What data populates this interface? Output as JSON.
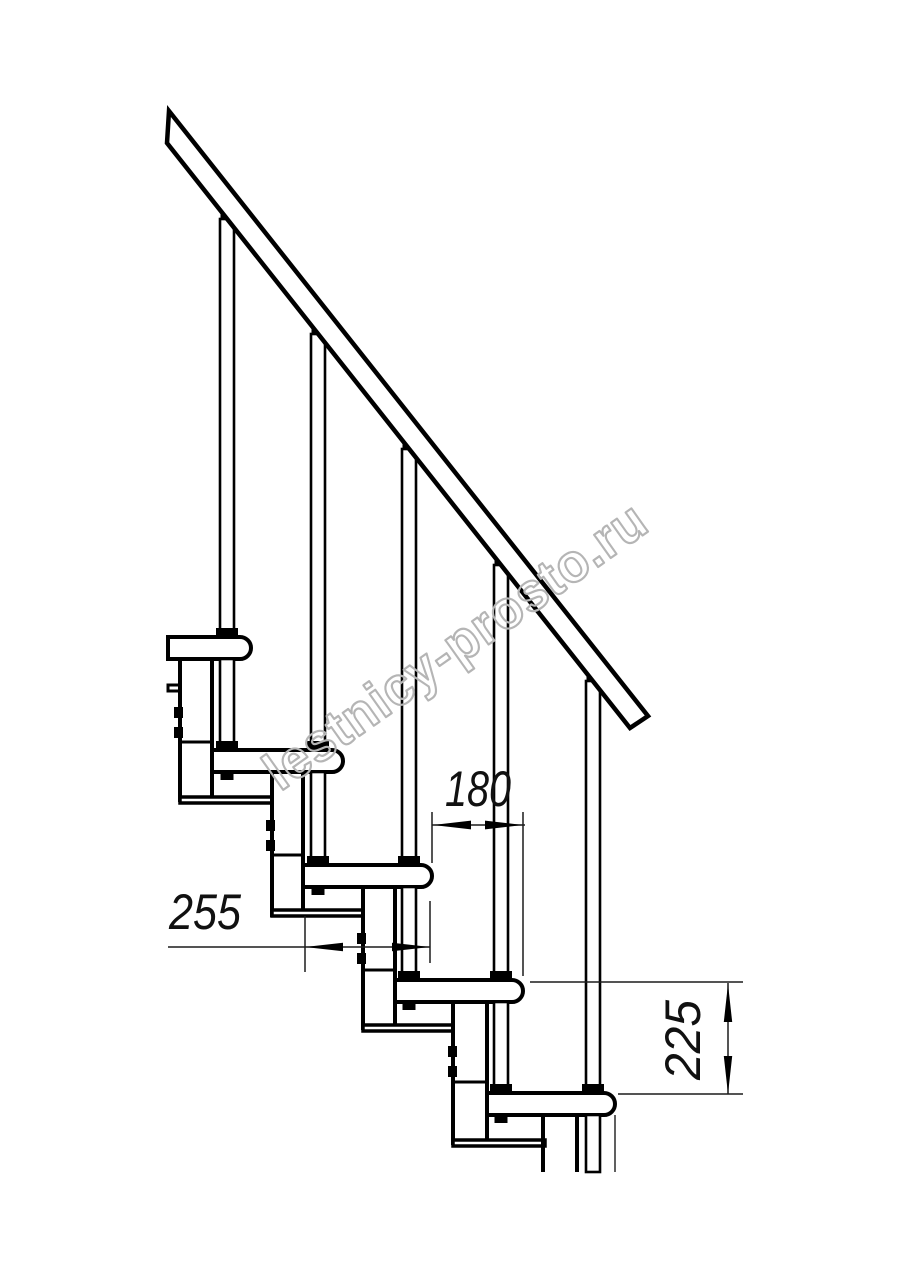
{
  "diagram": {
    "type": "technical-drawing",
    "subject": "modular-staircase-side-view-fragment",
    "watermark": "lestnicy-prosto.ru",
    "dimensions": {
      "tread_depth": "255",
      "step_run": "180",
      "step_rise": "225"
    },
    "treads_count": 5,
    "balusters_count": 5,
    "colors": {
      "line": "#000000",
      "dimension_line": "#1c1c1c",
      "watermark": "#b5b5b5",
      "background": "#ffffff"
    }
  }
}
